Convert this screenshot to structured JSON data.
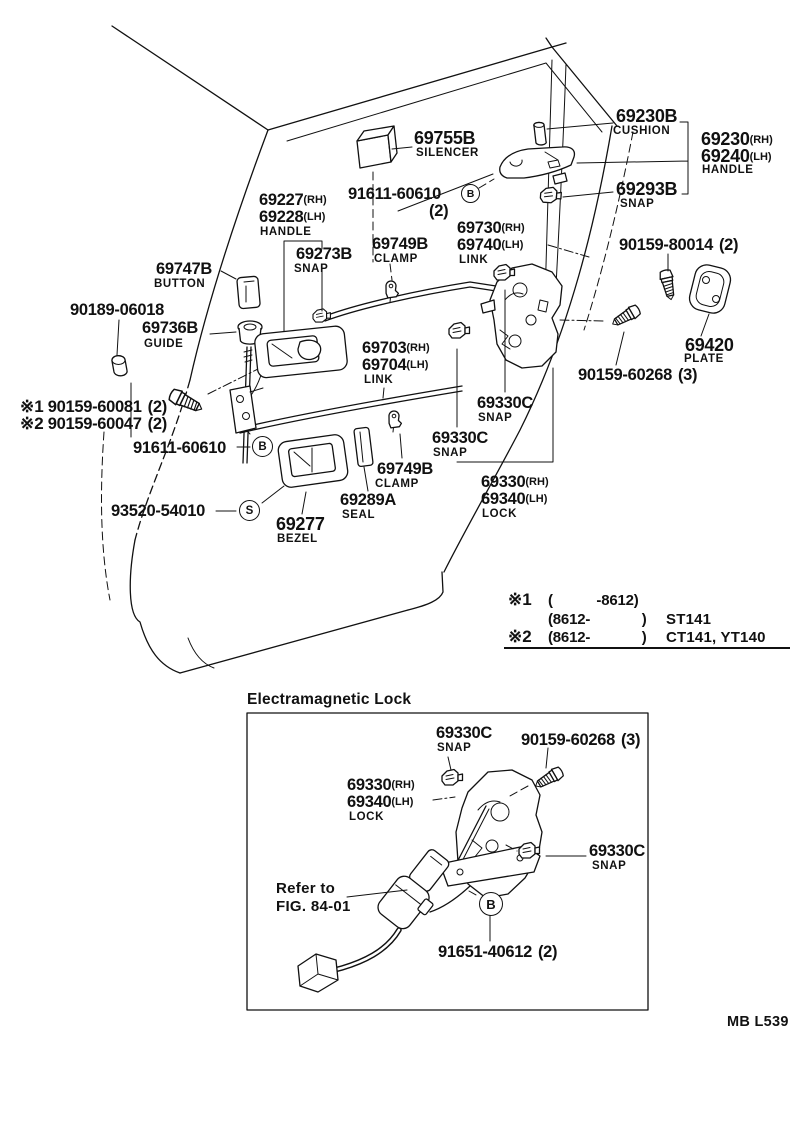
{
  "colors": {
    "ink": "#111111",
    "paper": "#ffffff"
  },
  "figure_code": "MB L539",
  "symbols": {
    "b": "B",
    "s": "S"
  },
  "inset": {
    "title": "Electramagnetic Lock",
    "refer_to_line1": "Refer to",
    "refer_to_line2": "FIG. 84-01"
  },
  "applicability": {
    "row1": {
      "sym": "※1",
      "range": "(           -8612)",
      "models": ""
    },
    "row2": {
      "sym": "",
      "range": "(8612-             )",
      "models": "ST141"
    },
    "row3": {
      "sym": "※2",
      "range": "(8612-             )",
      "models": "CT141, YT140"
    }
  },
  "parts": {
    "silencer": {
      "num": "69755B",
      "name": "SILENCER"
    },
    "cushion": {
      "num": "69230B",
      "name": "CUSHION"
    },
    "outer_handle": {
      "rh": "69230",
      "rh_s": "(RH)",
      "lh": "69240",
      "lh_s": "(LH)",
      "name": "HANDLE"
    },
    "outer_snap": {
      "num": "69293B",
      "name": "SNAP"
    },
    "screw_91611_upper": {
      "num": "91611-60610",
      "qty": "(2)"
    },
    "inner_handle": {
      "rh": "69227",
      "rh_s": "(RH)",
      "lh": "69228",
      "lh_s": "(LH)",
      "name": "HANDLE"
    },
    "inner_snap": {
      "num": "69273B",
      "name": "SNAP"
    },
    "clamp_upper": {
      "num": "69749B",
      "name": "CLAMP"
    },
    "link_outer": {
      "rh": "69730",
      "rh_s": "(RH)",
      "lh": "69740",
      "lh_s": "(LH)",
      "name": "LINK"
    },
    "screw_80014": {
      "num": "90159-80014",
      "qty": "(2)"
    },
    "button": {
      "num": "69747B",
      "name": "BUTTON"
    },
    "grommet": {
      "num": "90189-06018"
    },
    "guide": {
      "num": "69736B",
      "name": "GUIDE"
    },
    "plate": {
      "num": "69420",
      "name": "PLATE"
    },
    "link_inner": {
      "rh": "69703",
      "rh_s": "(RH)",
      "lh": "69704",
      "lh_s": "(LH)",
      "name": "LINK"
    },
    "screw_60268": {
      "num": "90159-60268",
      "qty": "(3)"
    },
    "screw_ref1": {
      "sym": "※1",
      "num": "90159-60081",
      "qty": "(2)"
    },
    "screw_ref2": {
      "sym": "※2",
      "num": "90159-60047",
      "qty": "(2)"
    },
    "screw_91611_lower": {
      "num": "91611-60610"
    },
    "snap_upper": {
      "num": "69330C",
      "name": "SNAP"
    },
    "snap_lower": {
      "num": "69330C",
      "name": "SNAP"
    },
    "lock": {
      "rh": "69330",
      "rh_s": "(RH)",
      "lh": "69340",
      "lh_s": "(LH)",
      "name": "LOCK"
    },
    "screw_93520": {
      "num": "93520-54010"
    },
    "seal": {
      "num": "69289A",
      "name": "SEAL"
    },
    "clamp_lower": {
      "num": "69749B",
      "name": "CLAMP"
    },
    "bezel": {
      "num": "69277",
      "name": "BEZEL"
    },
    "inset_snap_top": {
      "num": "69330C",
      "name": "SNAP"
    },
    "inset_screw_60268": {
      "num": "90159-60268",
      "qty": "(3)"
    },
    "inset_lock": {
      "rh": "69330",
      "rh_s": "(RH)",
      "lh": "69340",
      "lh_s": "(LH)",
      "name": "LOCK"
    },
    "inset_snap_right": {
      "num": "69330C",
      "name": "SNAP"
    },
    "inset_screw_91651": {
      "num": "91651-40612",
      "qty": "(2)"
    }
  }
}
